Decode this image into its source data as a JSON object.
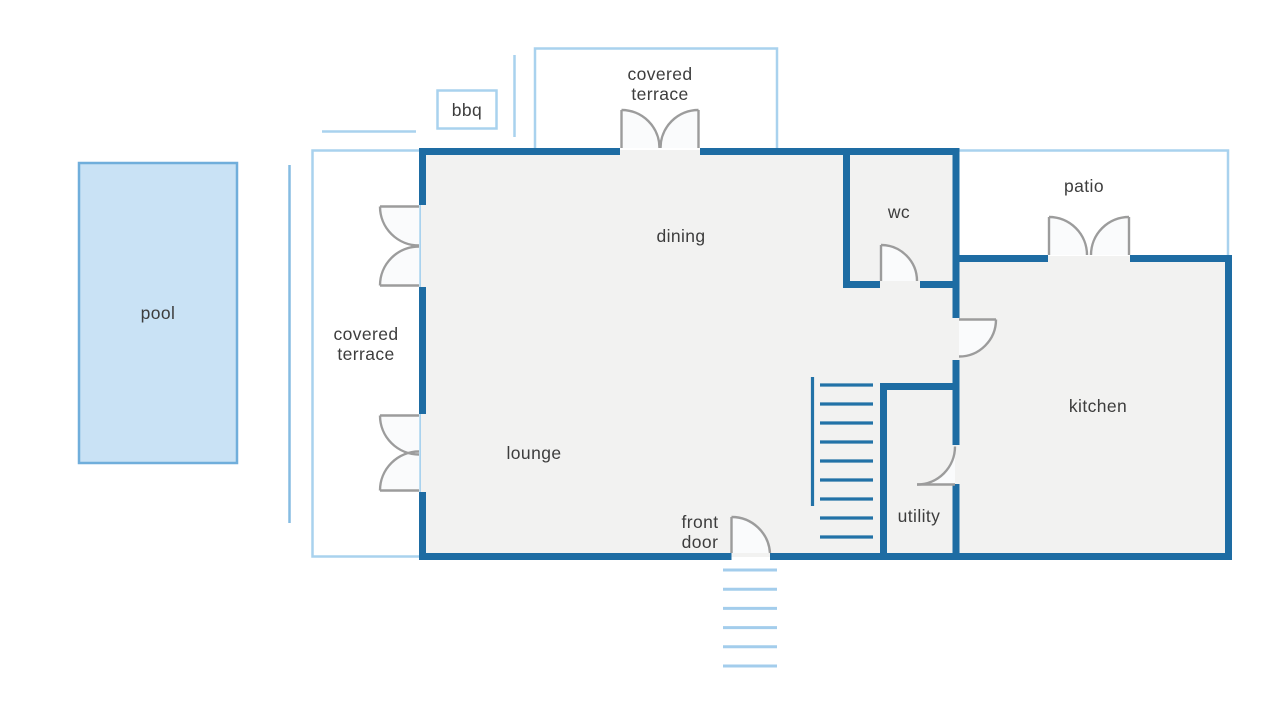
{
  "title": "house ground floor plan",
  "labels": {
    "pool": "pool",
    "covered": "covered",
    "terrace": "terrace",
    "bbq": "bbq",
    "dining": "dining",
    "wc": "wc",
    "patio": "patio",
    "lounge": "lounge",
    "kitchen": "kitchen",
    "utility": "utility",
    "front": "front",
    "door": "door"
  },
  "stairs": {
    "tread_count": 9
  },
  "front_steps": {
    "count": 6
  },
  "colors": {
    "wall": "#1e6ca3",
    "outline": "#a9d2ee",
    "accent_line": "#85bce2",
    "pool_fill": "#c9e2f5",
    "pool_border": "#70aedb",
    "floor": "#f2f2f1",
    "door": "#9c9c9c",
    "door_swing": "#fafbfc",
    "stair": "#2272a7",
    "step": "#a3cdec",
    "label": "#3d3d3d"
  }
}
